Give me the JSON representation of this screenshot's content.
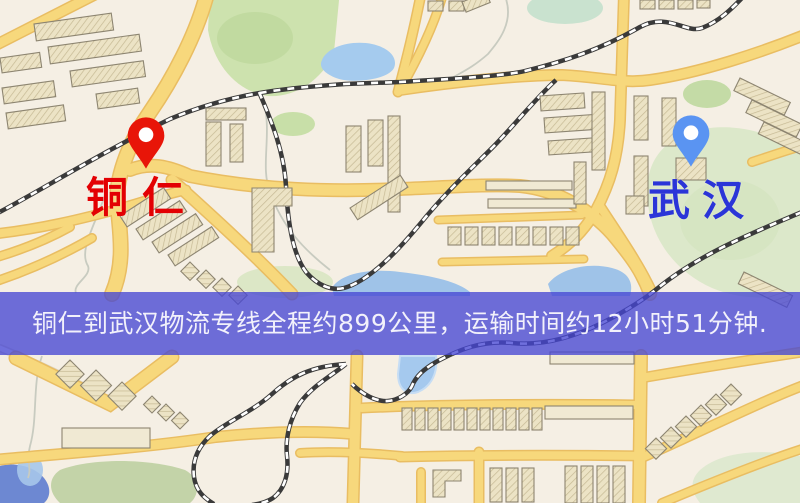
{
  "banner": {
    "text": "铜仁到武汉物流专线全程约899公里，运输时间约12小时51分钟.",
    "background": "rgba(70,70,212,0.78)",
    "text_color": "#f2f1fb"
  },
  "markers": {
    "origin": {
      "label": "铜仁",
      "label_color": "#e30003",
      "pin_color": "#e81508"
    },
    "destination": {
      "label": "武汉",
      "label_color": "#2b35d8",
      "pin_color": "#5a94f2"
    }
  },
  "route": {
    "distance_km": "899",
    "duration_hours": "12",
    "duration_minutes": "51"
  },
  "map_colors": {
    "background": "#f5efe4",
    "road": "#f7d87c",
    "road_casing": "#e9bd62",
    "park": "#cde2ae",
    "water": "#a5cbee",
    "railway": "#3a3a3a",
    "building": "#ece3c5"
  }
}
